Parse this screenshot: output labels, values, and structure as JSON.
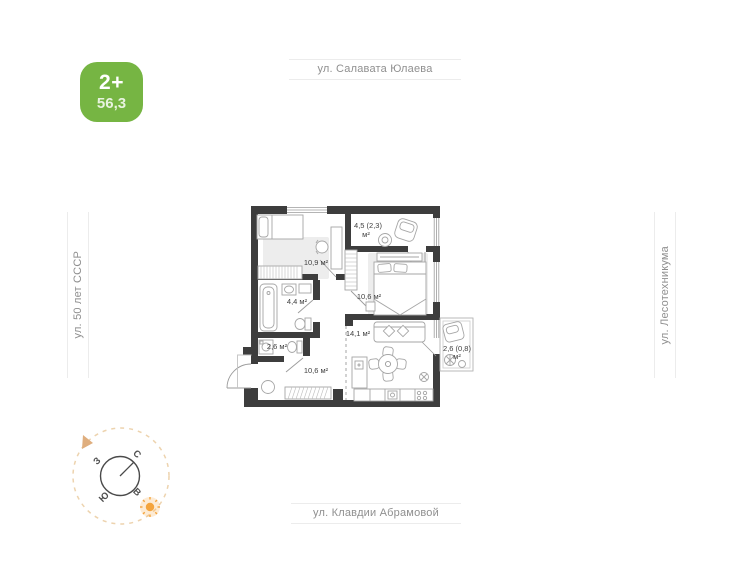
{
  "badge": {
    "rooms_label": "2+",
    "area_value": "56,3",
    "color": "#76b543"
  },
  "streets": {
    "top": "ул. Салавата Юлаева",
    "left": "ул. 50 лет СССР",
    "right": "ул. Лесотехникума",
    "bottom": "ул. Клавдии Абрамовой"
  },
  "compass": {
    "north": "С",
    "south": "Ю",
    "west": "З",
    "east": "В"
  },
  "floorplan": {
    "wall_color": "#3d3d3d",
    "rooms": [
      {
        "name": "bedroom-1",
        "label": "10,9 м²"
      },
      {
        "name": "loggia-top",
        "label": "4,5 (2,3)",
        "unit": "м²"
      },
      {
        "name": "bedroom-2",
        "label": "10,6 м²"
      },
      {
        "name": "kitchen-living",
        "label": "14,1 м²"
      },
      {
        "name": "bathroom",
        "label": "4,4 м²"
      },
      {
        "name": "wc",
        "label": "2,6 м²"
      },
      {
        "name": "hallway",
        "label": "10,6 м²"
      },
      {
        "name": "balcony-right",
        "label": "2,6 (0,8)",
        "unit": "м²"
      }
    ]
  }
}
